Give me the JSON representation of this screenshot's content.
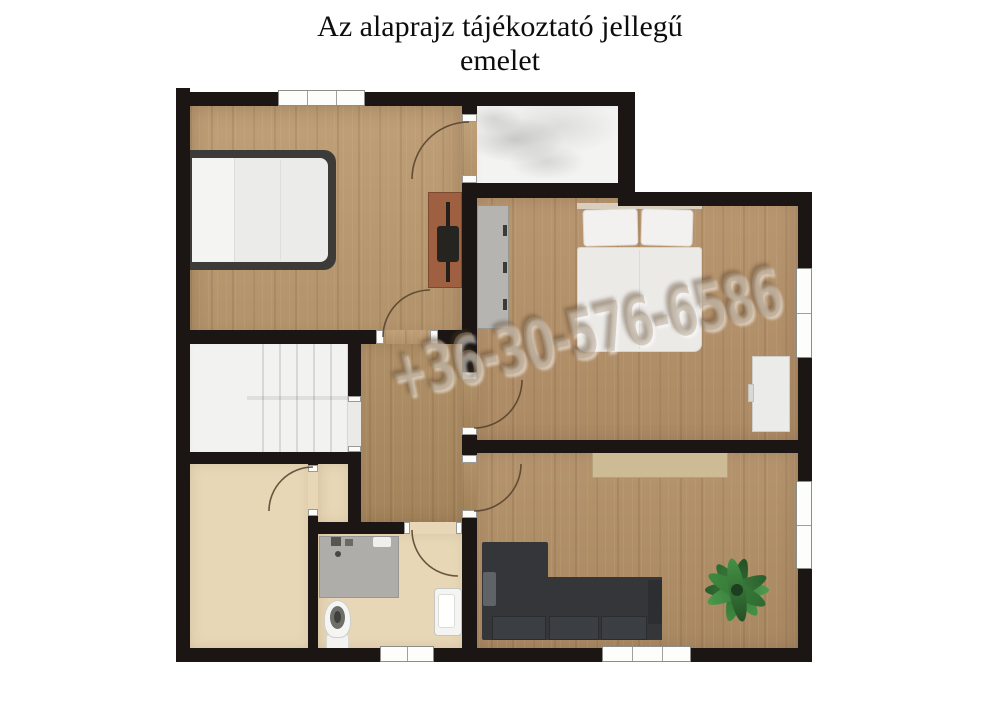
{
  "title": {
    "line1": "Az alaprajz tájékoztató jellegű",
    "line2": "emelet"
  },
  "watermark": "+36-30-576-6586",
  "palette": {
    "wall": "#1b1613",
    "wood_bedroom_left": "#bb9a70",
    "wood_hall": "#ab8a5f",
    "wood_bedroom_right": "#b59169",
    "wood_living": "#b18f66",
    "beige_floor": "#e7d7b6",
    "stairs_floor": "#f2f2f0",
    "terrace_floor": "#f3f3f2",
    "sofa": "#34363a",
    "sideboard": "#cdbb95",
    "plant": "#3a7d3c",
    "vanity": "#aeadaa",
    "desk": "#9e6040",
    "bed_frame": "#3c3b38",
    "bed_linen": "#eceae7",
    "wardrobe": "#b5b4b0"
  }
}
